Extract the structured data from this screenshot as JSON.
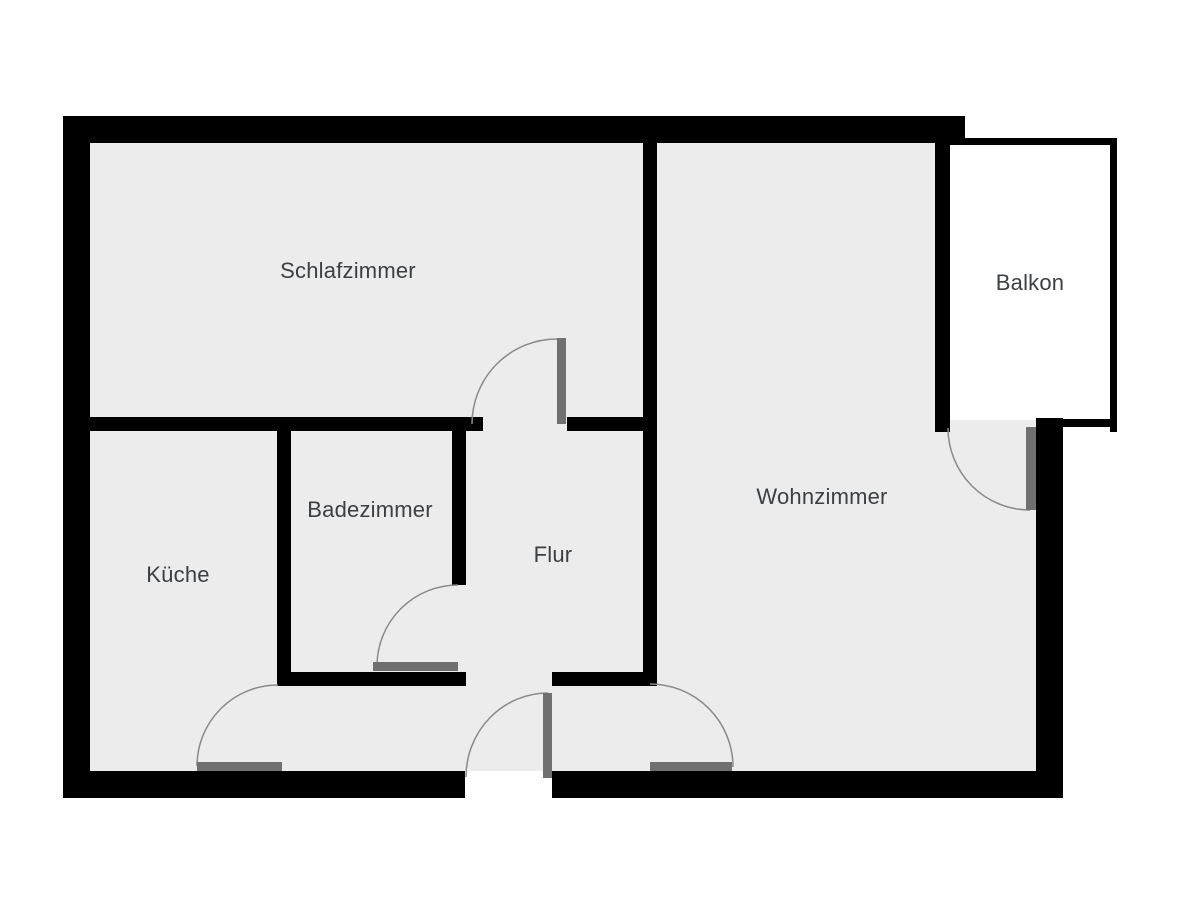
{
  "plan": {
    "rooms": {
      "schlafzimmer": {
        "label": "Schlafzimmer"
      },
      "balkon": {
        "label": "Balkon"
      },
      "wohnzimmer": {
        "label": "Wohnzimmer"
      },
      "badezimmer": {
        "label": "Badezimmer"
      },
      "flur": {
        "label": "Flur"
      },
      "kueche": {
        "label": "Küche"
      }
    },
    "colors": {
      "wall": "#000000",
      "floor": "#ececec",
      "balcony_floor": "#ffffff",
      "door_leaf": "#707070",
      "door_arc": "#8a8a8a",
      "label_text": "#3c4043",
      "background": "#ffffff"
    }
  }
}
